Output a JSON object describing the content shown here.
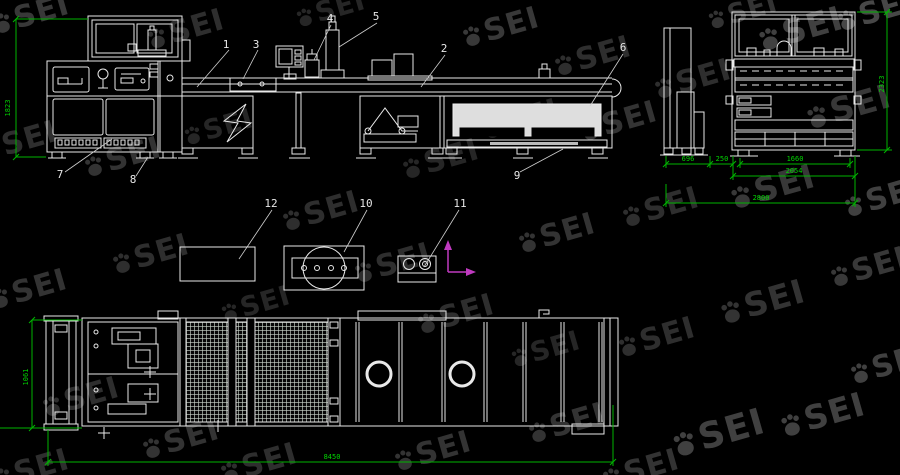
{
  "drawing": {
    "title": "machine-line-engineering-drawing",
    "callouts": {
      "c1": "1",
      "c2": "2",
      "c3": "3",
      "c4": "4",
      "c5": "5",
      "c6": "6",
      "c7": "7",
      "c8": "8",
      "c9": "9",
      "c10": "10",
      "c11": "11",
      "c12": "12"
    },
    "dimensions": {
      "side_height": "1823",
      "end_left_width": "696",
      "end_gap": "250",
      "end_inner_width": "1660",
      "end_body_width": "2054",
      "end_overall_width": "2800",
      "end_height": "2323",
      "plan_width": "1061",
      "plan_length": "8450"
    },
    "colors": {
      "background": "#000000",
      "line": "#e9e9e9",
      "dimension": "#00b400",
      "dimension_text": "#00d400",
      "axes": "#c03ac0",
      "watermark": "#ffffff"
    }
  },
  "watermark": {
    "text": "SEI",
    "positions": [
      [
        30,
        15,
        1,
        0.22
      ],
      [
        185,
        30,
        1,
        0.18
      ],
      [
        330,
        10,
        0.9,
        0.15
      ],
      [
        500,
        28,
        1,
        0.22
      ],
      [
        592,
        57,
        1,
        0.18
      ],
      [
        742,
        12,
        0.9,
        0.2
      ],
      [
        800,
        30,
        1.1,
        0.25
      ],
      [
        875,
        12,
        1,
        0.28
      ],
      [
        18,
        142,
        1,
        0.18
      ],
      [
        122,
        158,
        1,
        0.2
      ],
      [
        218,
        128,
        0.9,
        0.15
      ],
      [
        320,
        212,
        1,
        0.18
      ],
      [
        440,
        160,
        1,
        0.15
      ],
      [
        520,
        120,
        1,
        0.15
      ],
      [
        618,
        122,
        1,
        0.2
      ],
      [
        692,
        80,
        1,
        0.18
      ],
      [
        848,
        108,
        1.1,
        0.22
      ],
      [
        28,
        290,
        1,
        0.2
      ],
      [
        150,
        255,
        1,
        0.18
      ],
      [
        255,
        305,
        0.9,
        0.15
      ],
      [
        392,
        264,
        1,
        0.18
      ],
      [
        556,
        234,
        1,
        0.2
      ],
      [
        660,
        208,
        1,
        0.18
      ],
      [
        772,
        188,
        1.1,
        0.22
      ],
      [
        882,
        198,
        1,
        0.25
      ],
      [
        80,
        398,
        1,
        0.18
      ],
      [
        180,
        440,
        1,
        0.2
      ],
      [
        300,
        365,
        0.9,
        0.15
      ],
      [
        455,
        315,
        1,
        0.18
      ],
      [
        566,
        424,
        1,
        0.2
      ],
      [
        656,
        338,
        1,
        0.18
      ],
      [
        762,
        303,
        1.1,
        0.2
      ],
      [
        868,
        268,
        1,
        0.22
      ],
      [
        258,
        464,
        1,
        0.18
      ],
      [
        432,
        452,
        1,
        0.2
      ],
      [
        545,
        350,
        0.9,
        0.15
      ],
      [
        718,
        434,
        1.2,
        0.25
      ],
      [
        822,
        416,
        1.1,
        0.25
      ],
      [
        888,
        365,
        1,
        0.25
      ],
      [
        640,
        470,
        1,
        0.2
      ],
      [
        30,
        470,
        1,
        0.18
      ]
    ]
  }
}
